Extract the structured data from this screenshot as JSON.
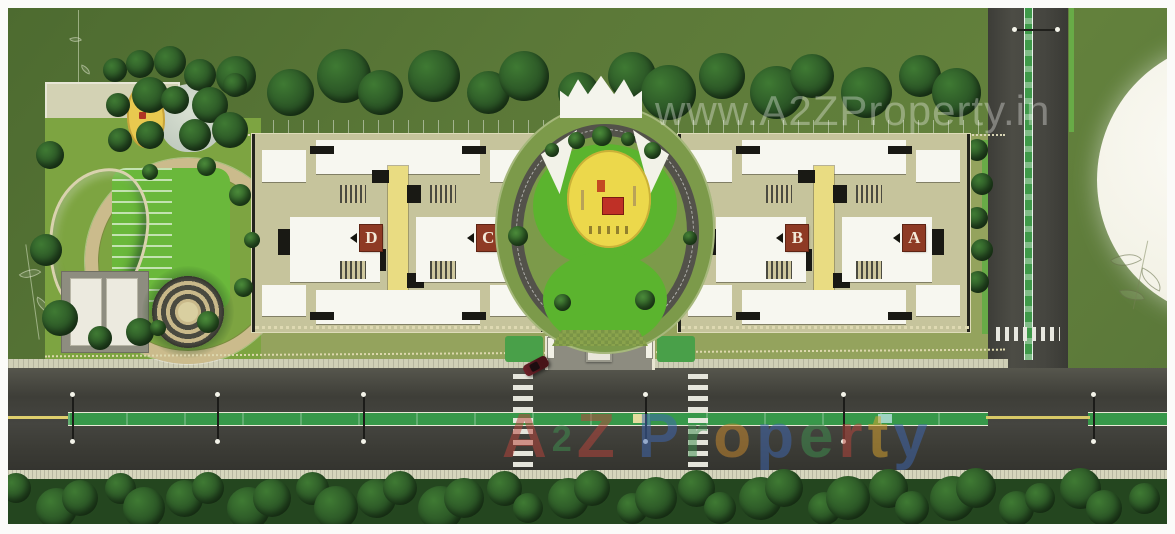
{
  "watermarks": {
    "site_url": "www.A2ZProperty.in",
    "brand": {
      "letters": [
        {
          "ch": "A",
          "color": "#b8453c"
        },
        {
          "ch": "2",
          "color": "#3f8f4f",
          "small": true
        },
        {
          "ch": "Z",
          "color": "#b8453c"
        },
        {
          "ch": " ",
          "color": ""
        },
        {
          "ch": "P",
          "color": "#3f67b0"
        },
        {
          "ch": "r",
          "color": "#3f8f4f"
        },
        {
          "ch": "o",
          "color": "#c98a2e"
        },
        {
          "ch": "p",
          "color": "#3f67b0"
        },
        {
          "ch": "e",
          "color": "#3f8f4f"
        },
        {
          "ch": "r",
          "color": "#b8453c"
        },
        {
          "ch": "t",
          "color": "#d9a42f"
        },
        {
          "ch": "y",
          "color": "#3f67b0"
        }
      ]
    }
  },
  "towers": [
    {
      "label": "D"
    },
    {
      "label": "C"
    },
    {
      "label": "B"
    },
    {
      "label": "A"
    }
  ],
  "palette": {
    "grass": "#5d7a3a",
    "lawn": "#6ab83b",
    "road": "#46463f",
    "median_green": "#37984a",
    "lane_yellow": "#dfcf6d",
    "pool_teal": "#1d7a8a",
    "building_white": "#f7f7f0",
    "building_khaki": "#c6c49c",
    "spine_yellow": "#e9dc82",
    "tower_label_bg": "#8e3a24",
    "playground_yellow": "#ecd84b",
    "tree_green": "#2c5426",
    "watermark_white": "rgba(248,248,245,0.34)"
  }
}
